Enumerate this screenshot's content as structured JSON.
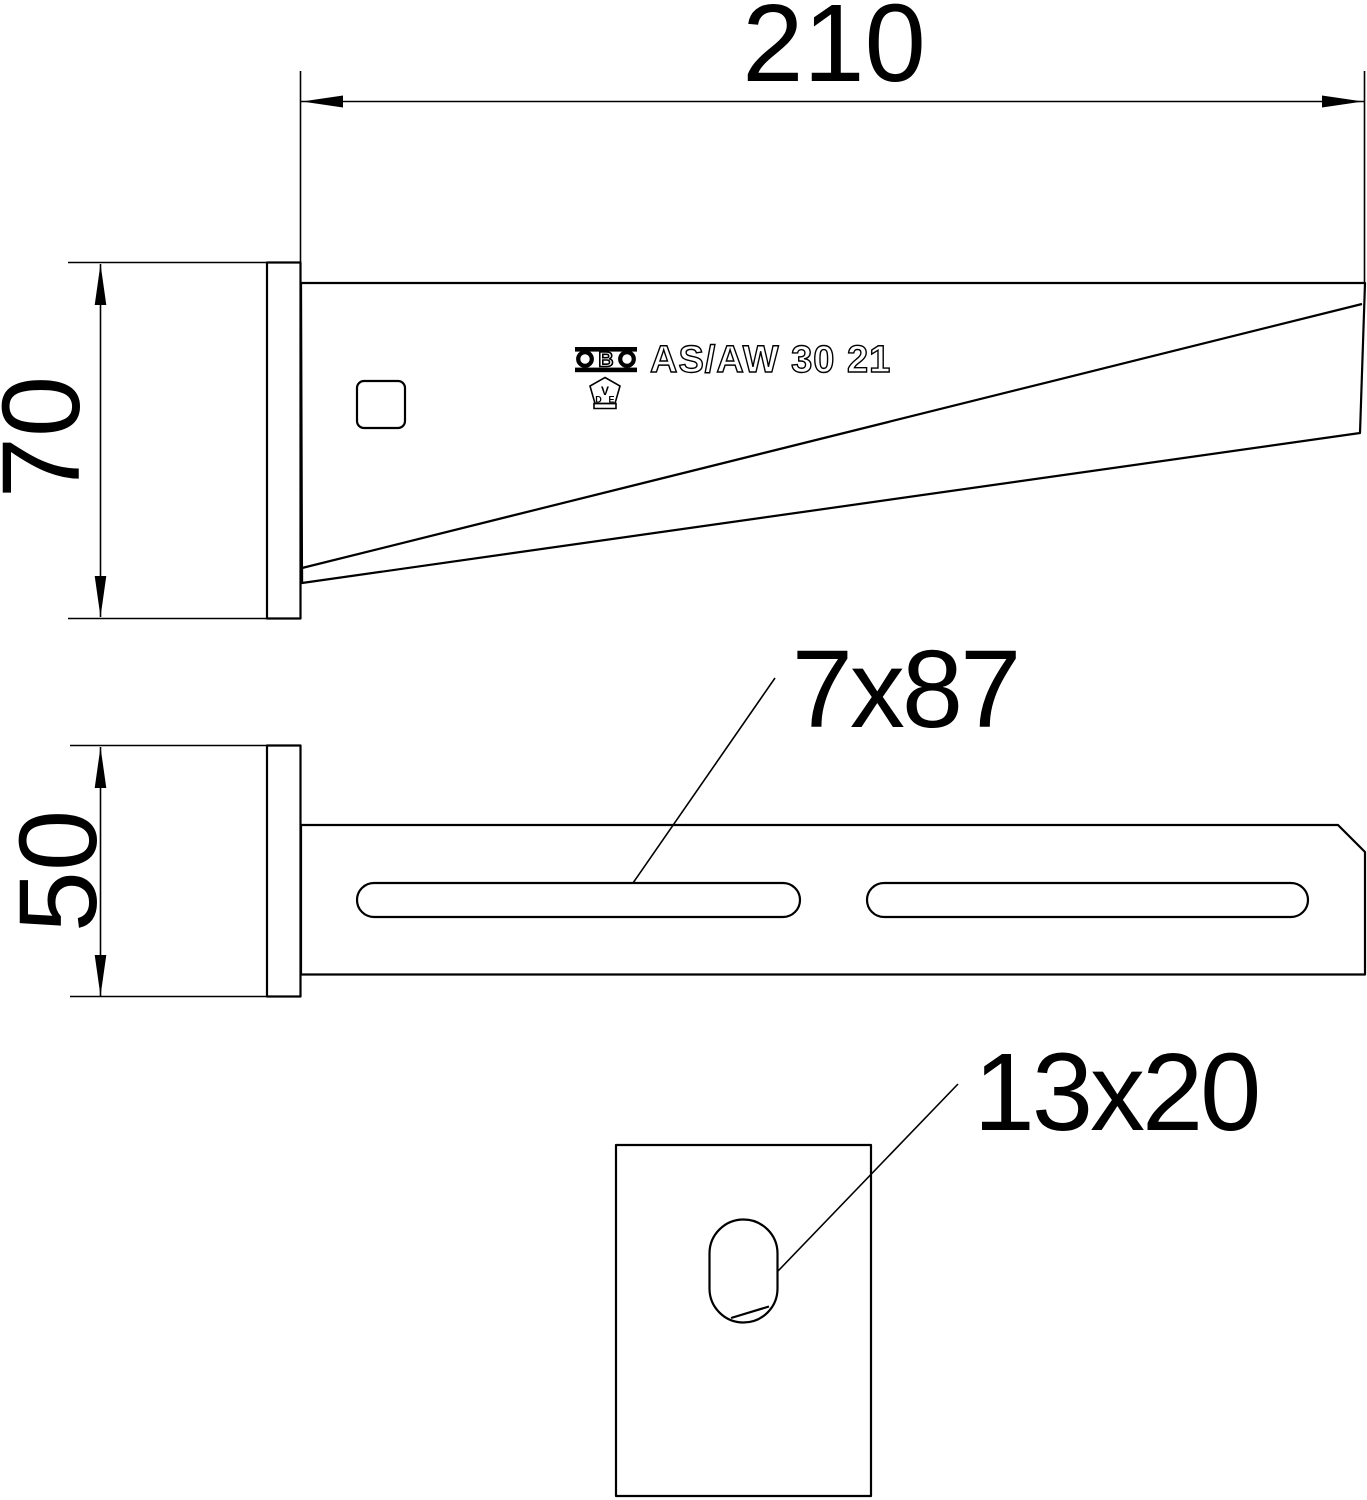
{
  "page": {
    "background": "#ffffff",
    "line_color": "#000000"
  },
  "dimensions": {
    "length": "210",
    "plate_height": "70",
    "plate_width": "50",
    "slot": "7x87",
    "anchor_hole": "13x20"
  },
  "stamp": {
    "product": "AS/AW 30 21",
    "obo_b": "B",
    "vde_v": "V",
    "vde_d": "D",
    "vde_e": "E"
  },
  "icons": {
    "obo_logo": "obo-brand-logo",
    "vde_mark": "vde-certification-mark"
  }
}
